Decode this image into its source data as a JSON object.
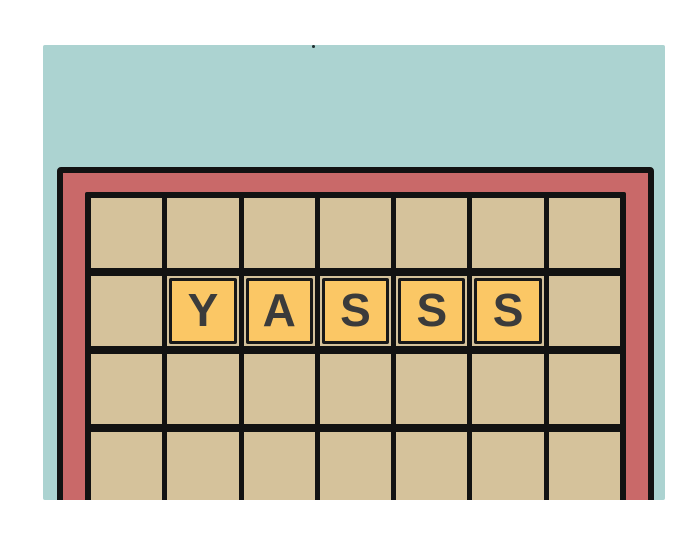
{
  "scene": {
    "description": "Cartoon illustration of a crossword game board with tiles spelling a word",
    "word": "YASSS"
  },
  "colors": {
    "background": "#ffffff",
    "wall": "#acd3d1",
    "frame": "#c96969",
    "line": "#121212",
    "cell": "#d5c29b",
    "tile": "#fbc765",
    "tile_border": "#181818",
    "letter": "#3b3b3b",
    "speck": "#1e2e2e"
  },
  "board": {
    "columns": 7,
    "rows": 4,
    "tiles": [
      {
        "letter": "Y",
        "row": 2,
        "col": 2
      },
      {
        "letter": "A",
        "row": 2,
        "col": 3
      },
      {
        "letter": "S",
        "row": 2,
        "col": 4
      },
      {
        "letter": "S",
        "row": 2,
        "col": 5
      },
      {
        "letter": "S",
        "row": 2,
        "col": 6
      }
    ]
  }
}
